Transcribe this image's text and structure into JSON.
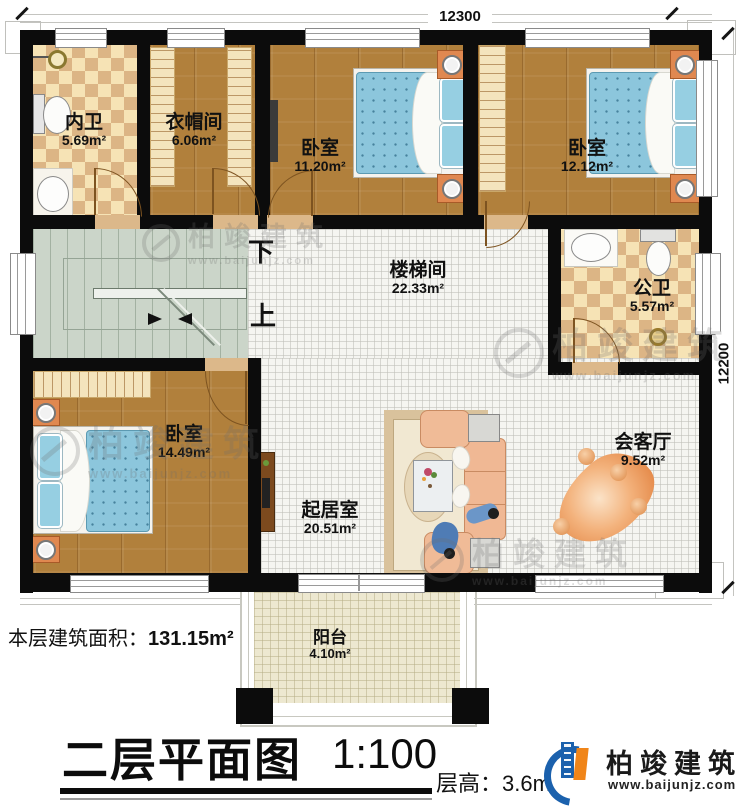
{
  "title_block": {
    "plan_title": "二层平面图",
    "scale": "1:100",
    "floor_height": "层高：3.6m",
    "area_label": "本层建筑面积：",
    "area_value": "131.15m²"
  },
  "dimensions": {
    "top": "12300",
    "right": "12200"
  },
  "stairs": {
    "down_label": "下",
    "up_label": "上"
  },
  "rooms": [
    {
      "name": "内卫",
      "area": "5.69m²"
    },
    {
      "name": "衣帽间",
      "area": "6.06m²"
    },
    {
      "name": "卧室",
      "area": "11.20m²"
    },
    {
      "name": "卧室",
      "area": "12.12m²"
    },
    {
      "name": "楼梯间",
      "area": "22.33m²"
    },
    {
      "name": "公卫",
      "area": "5.57m²"
    },
    {
      "name": "卧室",
      "area": "14.49m²"
    },
    {
      "name": "起居室",
      "area": "20.51m²"
    },
    {
      "name": "会客厅",
      "area": "9.52m²"
    },
    {
      "name": "阳台",
      "area": "4.10m²"
    }
  ],
  "branding": {
    "company": "柏竣建筑",
    "website": "www.baijunjz.com"
  },
  "watermark": {
    "company": "柏竣建筑",
    "website": "www.baijunjz.com"
  },
  "colors": {
    "wall": "#0c0c0c",
    "wood": "#b1803c",
    "tile_check_light": "#f6e3b5",
    "tile_check_dark": "#dcb585",
    "stair": "#cbd5c9",
    "bed": "#8cc6dc",
    "accent_orange": "#f08519",
    "logo_blue": "#1b61ad"
  }
}
